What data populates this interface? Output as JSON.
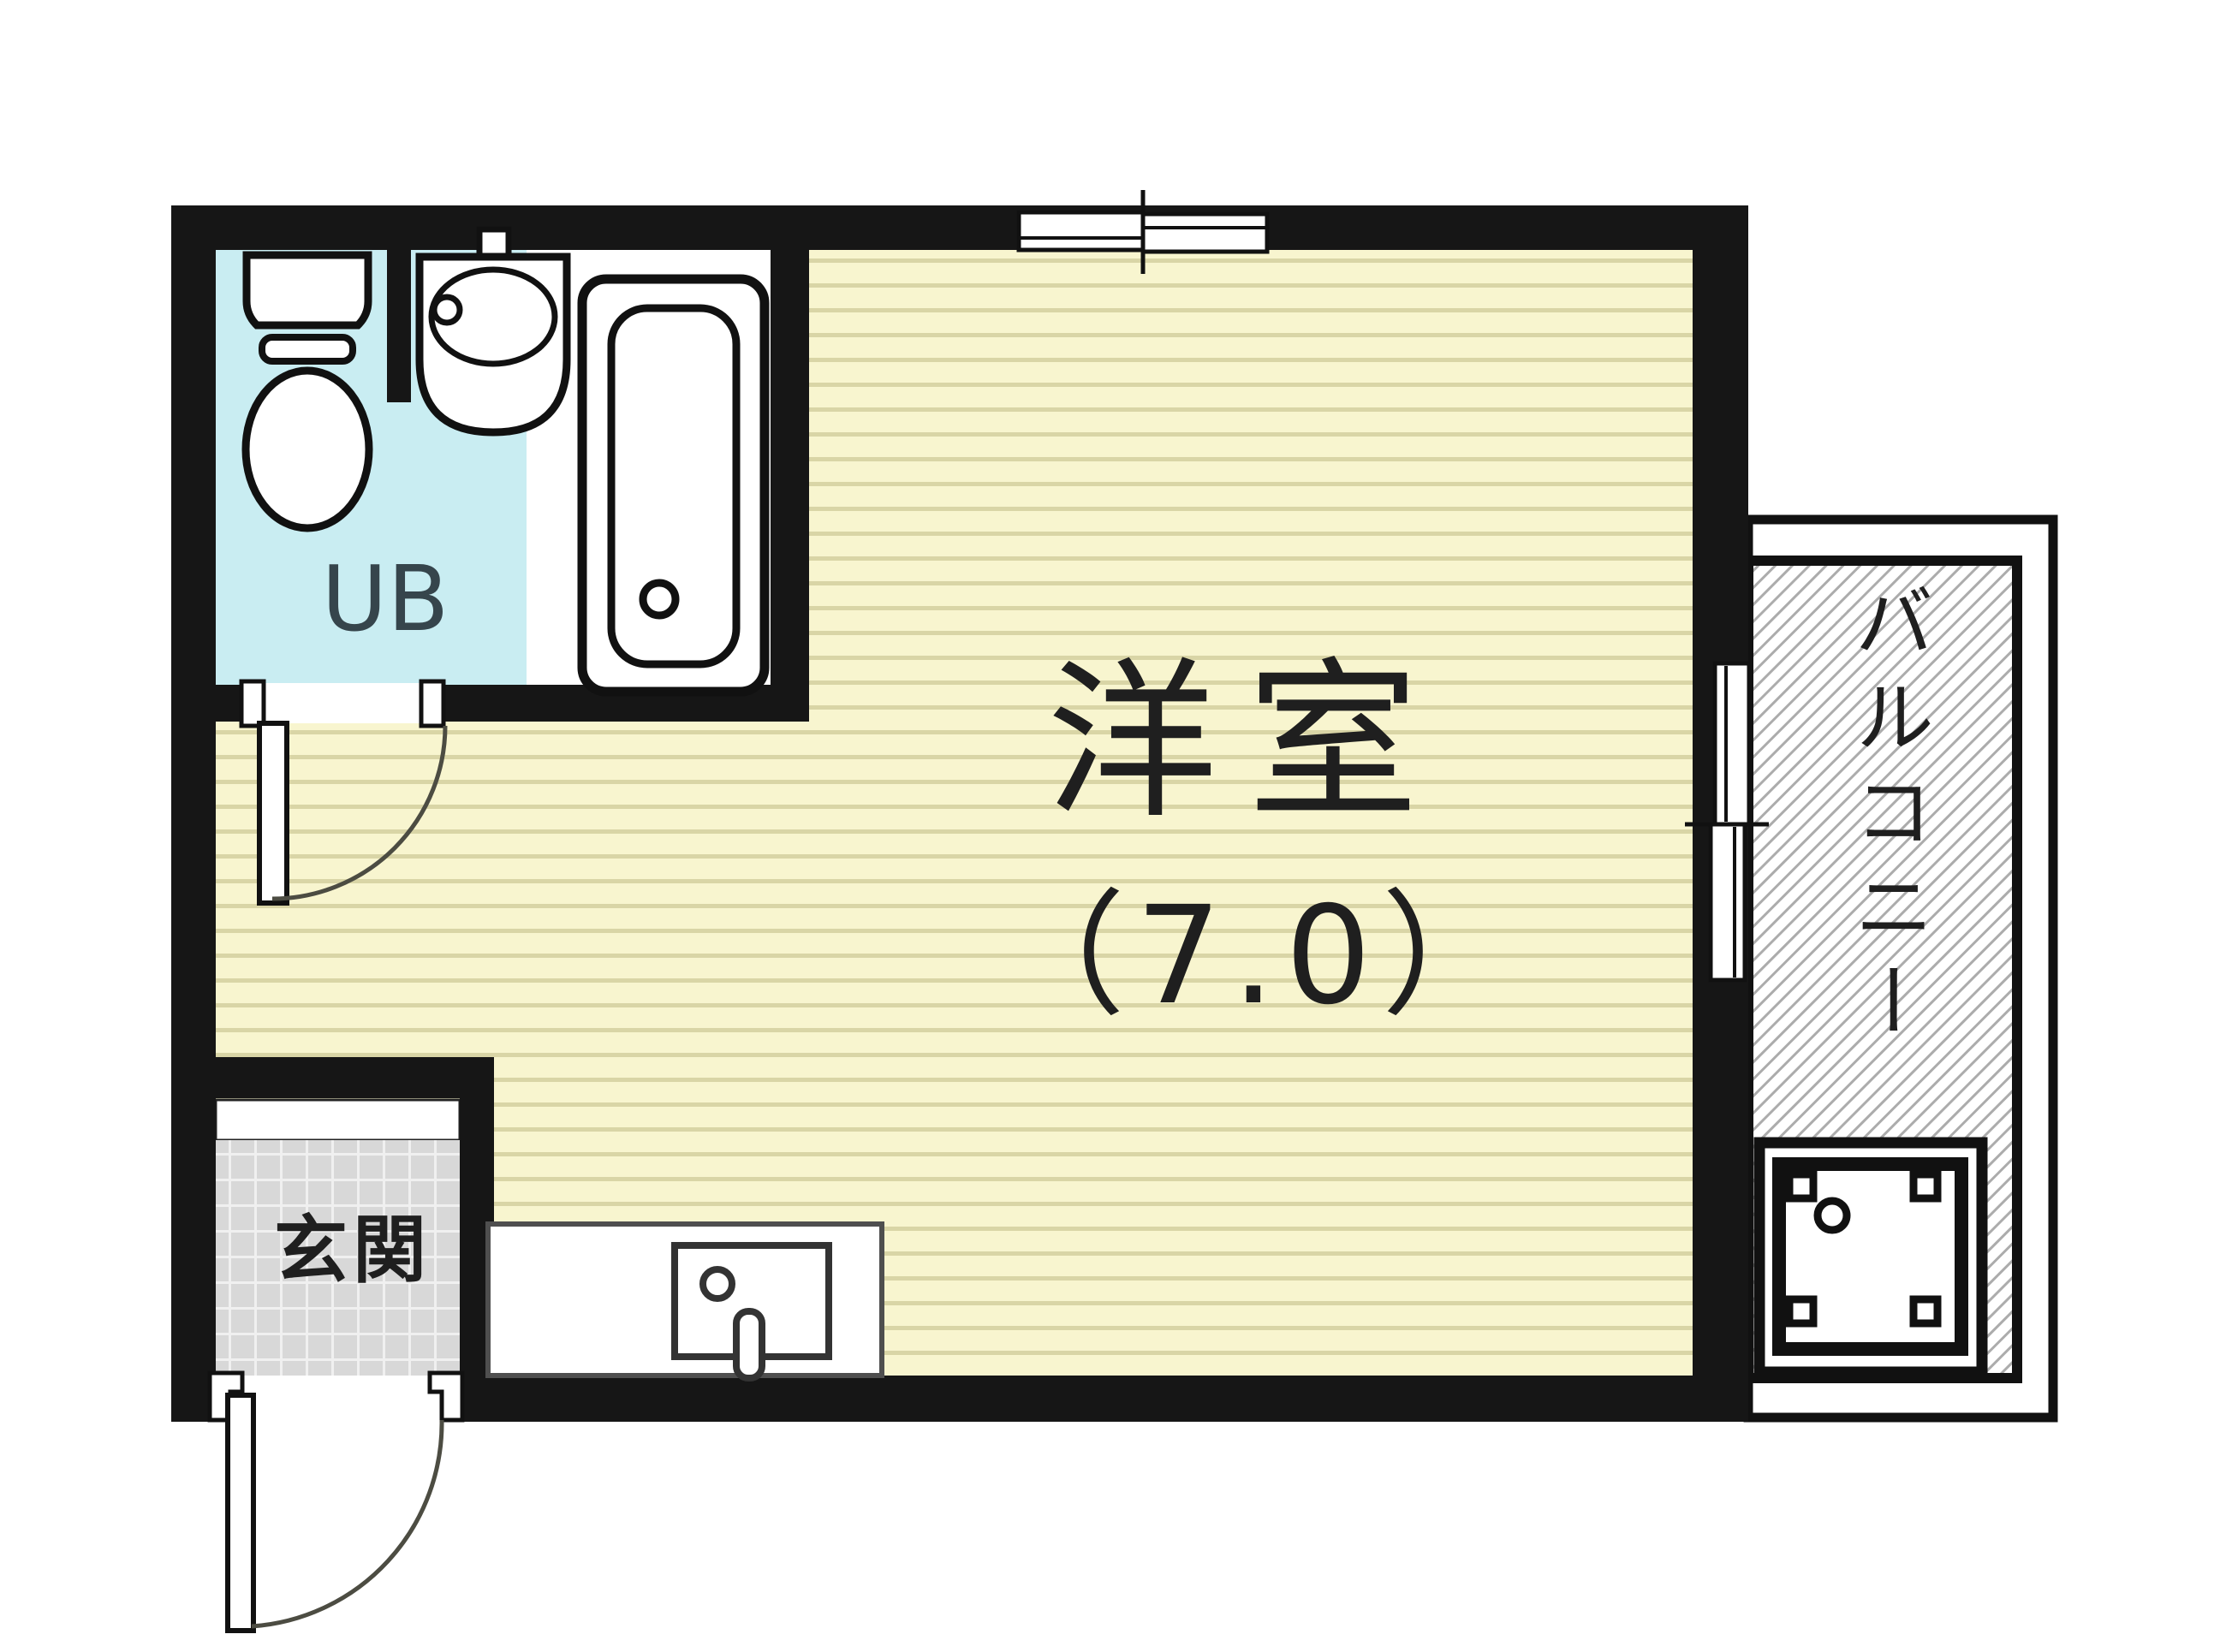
{
  "floorplan": {
    "main_room": {
      "label": "洋室",
      "size": "（7.0）"
    },
    "unit_bath": {
      "label": "UB"
    },
    "entrance": {
      "label": "玄関"
    },
    "balcony": {
      "label": "バルコニー"
    }
  },
  "colors": {
    "wall": "#161616",
    "outline": "#111111",
    "floor": "#f8f5cf",
    "floor_line": "#d9d5a6",
    "ub": "#c9edf2",
    "bath": "#ffffff",
    "tile": "#d8d8d8",
    "tile_line": "#f0f0f0",
    "hatch_line": "#acacac",
    "arc": "#4c4c42",
    "counter_line": "#4f4f4f",
    "label": "#1f1f1f",
    "ub_label": "#36454c"
  }
}
